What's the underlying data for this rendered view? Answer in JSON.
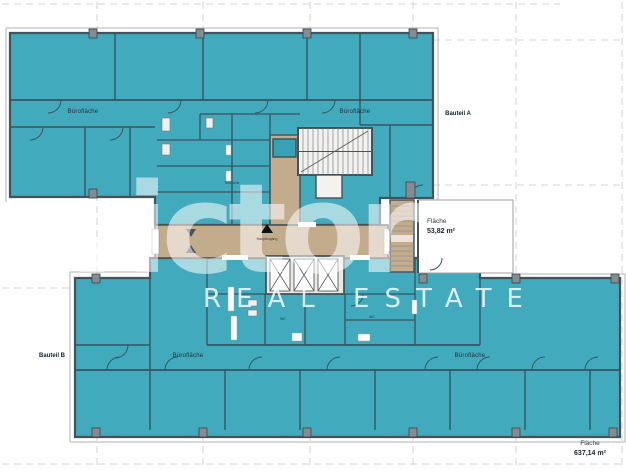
{
  "watermark": {
    "logo": "victor",
    "tagline": "REAL ESTATE"
  },
  "sections": {
    "bauteil_a": "Bauteil A",
    "bauteil_b": "Bauteil B"
  },
  "zones": {
    "office_top_left": "Bürofläche",
    "office_top_right": "Bürofläche",
    "office_bottom_left": "Bürofläche",
    "office_bottom_right": "Bürofläche"
  },
  "areas": {
    "terrace": {
      "label": "Fläche",
      "value": "53,82 m²"
    },
    "total": {
      "label": "Fläche",
      "value": "637,14 m²"
    }
  },
  "rooms": {
    "kitchen": "Teeküche",
    "wc_left": "WC",
    "wc_right": "WC",
    "entrance": "Hauptzugang"
  },
  "colors": {
    "office_fill": "#41aabd",
    "corridor_fill": "#c3ac8b",
    "wall": "#45525a",
    "watermark": "#ffffff"
  }
}
